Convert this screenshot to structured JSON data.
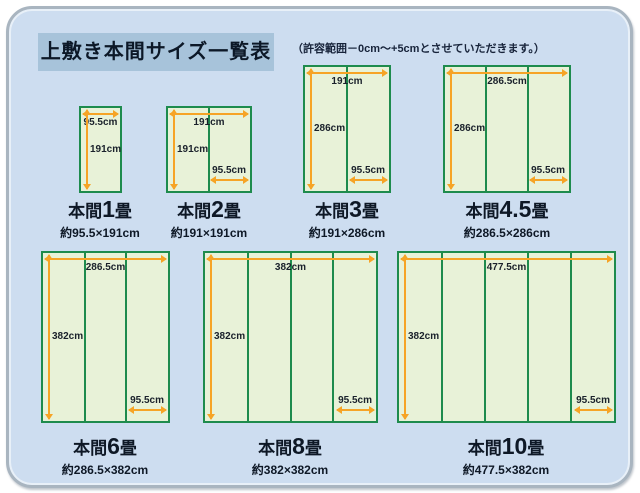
{
  "page": {
    "title": "上敷き本間サイズ一覧表",
    "note": "（許容範囲－0cm～+5cmとさせていただきます。）"
  },
  "colors": {
    "panel_bg": "#cdddf0",
    "panel_border": "#a9b5c0",
    "title_bg": "#a7c3da",
    "text": "#0e1826",
    "mat_fill": "#e8f2d8",
    "mat_border": "#1e8b4d",
    "measure_line": "#f6a426"
  },
  "diagrams": [
    {
      "id": "honma-1jo",
      "prefix": "本間",
      "number": "1",
      "unit": "畳",
      "size": "約95.5×191cm",
      "top_label": "95.5cm",
      "side_label": "191cm",
      "bottom_label": "",
      "mat_count": 1
    },
    {
      "id": "honma-2jo",
      "prefix": "本間",
      "number": "2",
      "unit": "畳",
      "size": "約191×191cm",
      "top_label": "191cm",
      "side_label": "191cm",
      "bottom_label": "95.5cm",
      "mat_count": 2
    },
    {
      "id": "honma-3jo",
      "prefix": "本間",
      "number": "3",
      "unit": "畳",
      "size": "約191×286cm",
      "top_label": "191cm",
      "side_label": "286cm",
      "bottom_label": "95.5cm",
      "mat_count": 2
    },
    {
      "id": "honma-45jo",
      "prefix": "本間",
      "number": "4.5",
      "unit": "畳",
      "size": "約286.5×286cm",
      "top_label": "286.5cm",
      "side_label": "286cm",
      "bottom_label": "95.5cm",
      "mat_count": 3
    },
    {
      "id": "honma-6jo",
      "prefix": "本間",
      "number": "6",
      "unit": "畳",
      "size": "約286.5×382cm",
      "top_label": "286.5cm",
      "side_label": "382cm",
      "bottom_label": "95.5cm",
      "mat_count": 3
    },
    {
      "id": "honma-8jo",
      "prefix": "本間",
      "number": "8",
      "unit": "畳",
      "size": "約382×382cm",
      "top_label": "382cm",
      "side_label": "382cm",
      "bottom_label": "95.5cm",
      "mat_count": 4
    },
    {
      "id": "honma-10jo",
      "prefix": "本間",
      "number": "10",
      "unit": "畳",
      "size": "約477.5×382cm",
      "top_label": "477.5cm",
      "side_label": "382cm",
      "bottom_label": "95.5cm",
      "mat_count": 5
    }
  ]
}
